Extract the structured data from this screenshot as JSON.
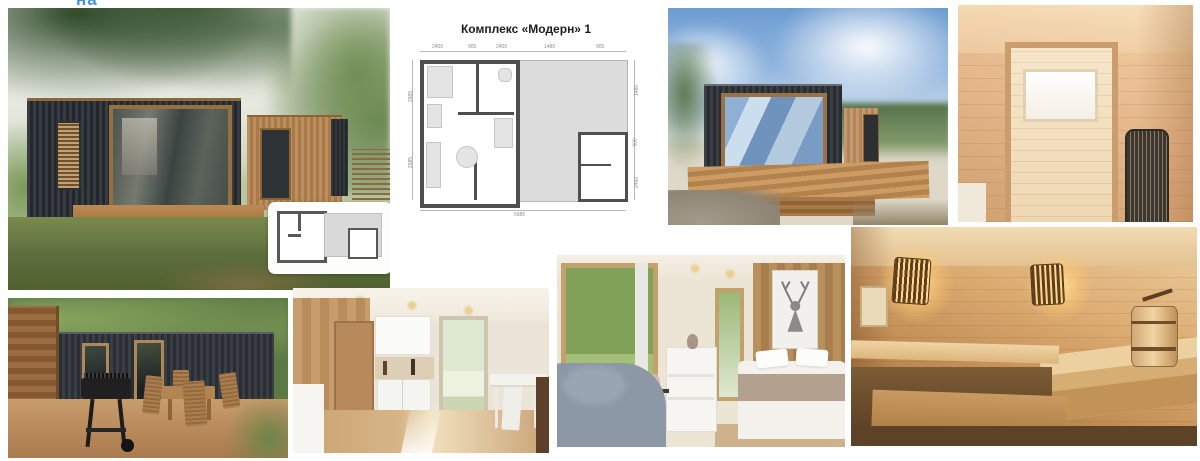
{
  "page": {
    "background": "#ffffff",
    "accent_blue": "#4193d6"
  },
  "overlay_text": {
    "cropped_label": "на"
  },
  "floor_plan": {
    "title": "Комплекс «Модерн» 1",
    "wall_color": "#4f4f4f",
    "deck_color": "#dcdcdc",
    "dims": {
      "top": [
        "2400",
        "900",
        "2400",
        "1480",
        "900"
      ],
      "bottom": [
        "5985"
      ],
      "left": [
        "2985",
        "2985"
      ],
      "right": [
        "1480",
        "900",
        "2400"
      ]
    }
  },
  "photos": {
    "p1": {
      "desc": "Exterior of dark modular cabin with corner glazing, wood deck steps and pine branches; small floor-plan inset card"
    },
    "p3": {
      "desc": "Dark cabin with mirrored glass corner on wooden deck under blue sky with clouds"
    },
    "p4": {
      "desc": "Light pine interior with doorway, small bright window and mesh sauna heater"
    },
    "p5": {
      "desc": "Patio with black BBQ grill, wooden folding table and chairs in front of dark cabin"
    },
    "p6": {
      "desc": "Interior kitchen corner with white cabinets, glass door and white dining table"
    },
    "p7": {
      "desc": "Bedroom with large forest-view window, grey armchair, white dresser, bed and deer poster on wood wall"
    },
    "p8": {
      "desc": "Sauna interior with glowing slatted sconces, wooden benches and bucket"
    }
  }
}
